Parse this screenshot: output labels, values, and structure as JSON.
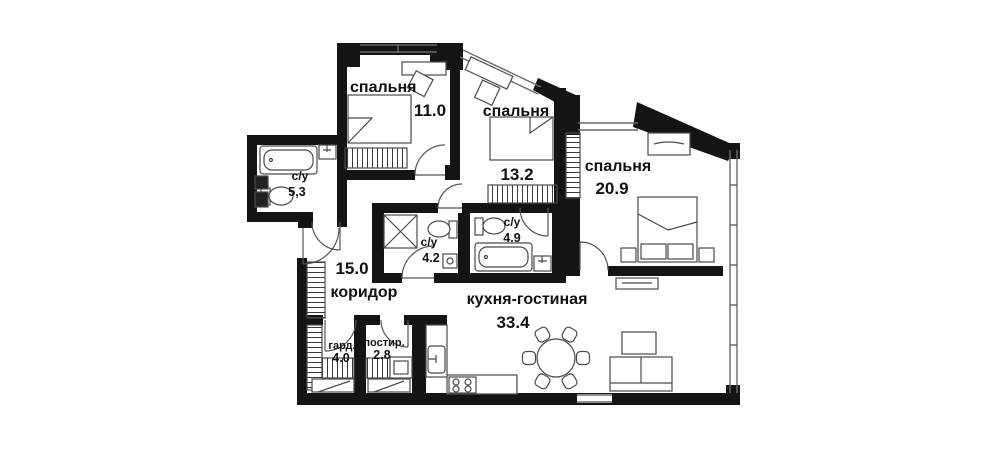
{
  "plan": {
    "title": "apartment floor plan",
    "rooms": [
      {
        "id": "bedroom-1",
        "label": "спальня",
        "area": "11.0"
      },
      {
        "id": "bedroom-2",
        "label": "спальня",
        "area": "13.2"
      },
      {
        "id": "bedroom-3",
        "label": "спальня",
        "area": "20.9"
      },
      {
        "id": "bathroom-1",
        "label": "с/у",
        "area": "5,3"
      },
      {
        "id": "bathroom-2",
        "label": "с/у",
        "area": "4.2"
      },
      {
        "id": "bathroom-3",
        "label": "с/у",
        "area": "4.9"
      },
      {
        "id": "corridor",
        "label": "коридор",
        "area": "15.0"
      },
      {
        "id": "kitchen-living",
        "label": "кухня-гостиная",
        "area": "33.4"
      },
      {
        "id": "wardrobe",
        "label": "гард.",
        "area": "4.0"
      },
      {
        "id": "laundry",
        "label": "постир.",
        "area": "2.8"
      }
    ],
    "colors": {
      "wall": "#141414",
      "furniture_line": "#4a4a4a",
      "window_line": "#6a6a6a",
      "background": "#ffffff"
    }
  }
}
